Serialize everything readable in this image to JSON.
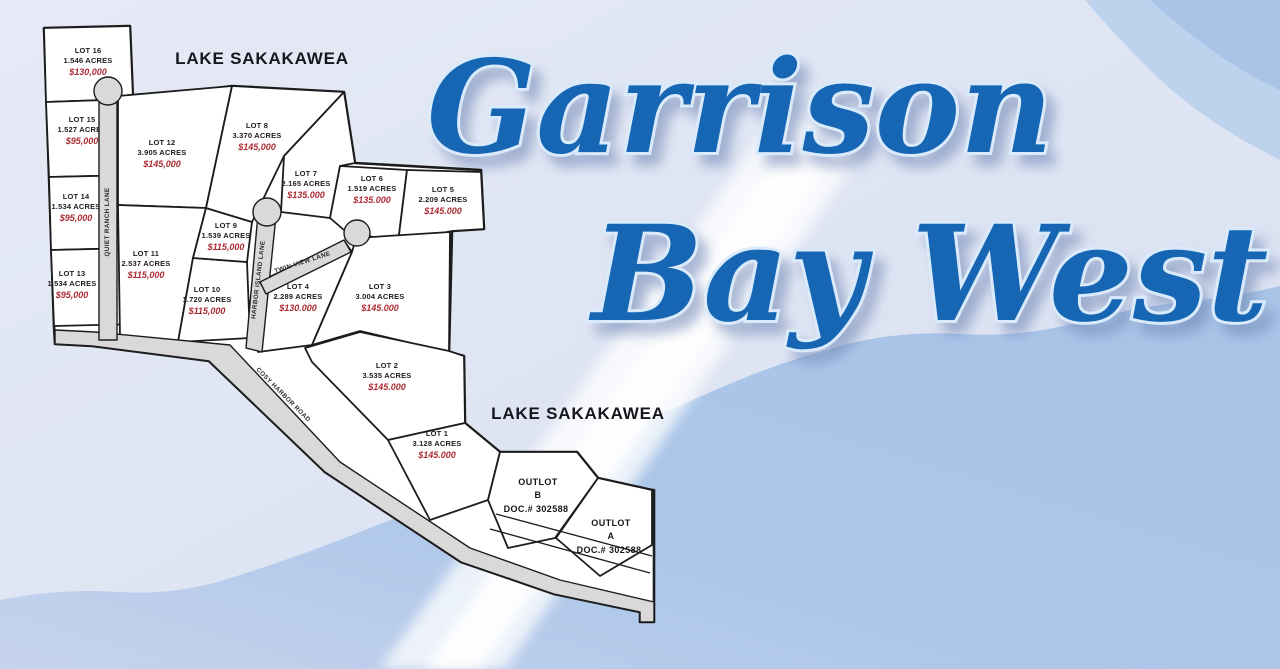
{
  "title": {
    "line1": "Garrison",
    "line2": "Bay West"
  },
  "lake_label_top": "LAKE SAKAKAWEA",
  "lake_label_bottom": "LAKE SAKAKAWEA",
  "roads": {
    "quiet_ranch": "QUIET RANCH LANE",
    "harbor_island": "HARBOR ISLAND LANE",
    "twin_view": "TWIN VIEW LANE",
    "cosy_harbor": "COSY HARBOR ROAD"
  },
  "lots": {
    "lot16": {
      "name": "LOT 16",
      "acres": "1.546 ACRES",
      "price": "$130,000"
    },
    "lot15": {
      "name": "LOT 15",
      "acres": "1.527 ACRES",
      "price": "$95,000"
    },
    "lot14": {
      "name": "LOT 14",
      "acres": "1.534 ACRES",
      "price": "$95,000"
    },
    "lot13": {
      "name": "LOT 13",
      "acres": "1.534 ACRES",
      "price": "$95,000"
    },
    "lot12": {
      "name": "LOT 12",
      "acres": "3.905 ACRES",
      "price": "$145,000"
    },
    "lot11": {
      "name": "LOT 11",
      "acres": "2.537 ACRES",
      "price": "$115,000"
    },
    "lot10": {
      "name": "LOT 10",
      "acres": "1.720 ACRES",
      "price": "$115,000"
    },
    "lot9": {
      "name": "LOT 9",
      "acres": "1.539 ACRES",
      "price": "$115,000"
    },
    "lot8": {
      "name": "LOT 8",
      "acres": "3.370 ACRES",
      "price": "$145,000"
    },
    "lot7": {
      "name": "LOT 7",
      "acres": "2.165 ACRES",
      "price": "$135.000"
    },
    "lot6": {
      "name": "LOT 6",
      "acres": "1.519 ACRES",
      "price": "$135.000"
    },
    "lot5": {
      "name": "LOT 5",
      "acres": "2.209 ACRES",
      "price": "$145.000"
    },
    "lot4": {
      "name": "LOT 4",
      "acres": "2.289 ACRES",
      "price": "$130.000"
    },
    "lot3": {
      "name": "LOT 3",
      "acres": "3.004 ACRES",
      "price": "$145.000"
    },
    "lot2": {
      "name": "LOT 2",
      "acres": "3.535 ACRES",
      "price": "$145.000"
    },
    "lot1": {
      "name": "LOT 1",
      "acres": "3.128 ACRES",
      "price": "$145.000"
    }
  },
  "outlots": {
    "b": {
      "name": "OUTLOT",
      "letter": "B",
      "doc": "DOC.# 302588"
    },
    "a": {
      "name": "OUTLOT",
      "letter": "A",
      "doc": "DOC.# 302588"
    }
  },
  "colors": {
    "title_blue": "#1766b4",
    "price_red": "#ab2a32",
    "lake_blue": "#a9c4e7",
    "pale_background": "#e2e6f3",
    "road_grey": "#d9d9d9"
  }
}
